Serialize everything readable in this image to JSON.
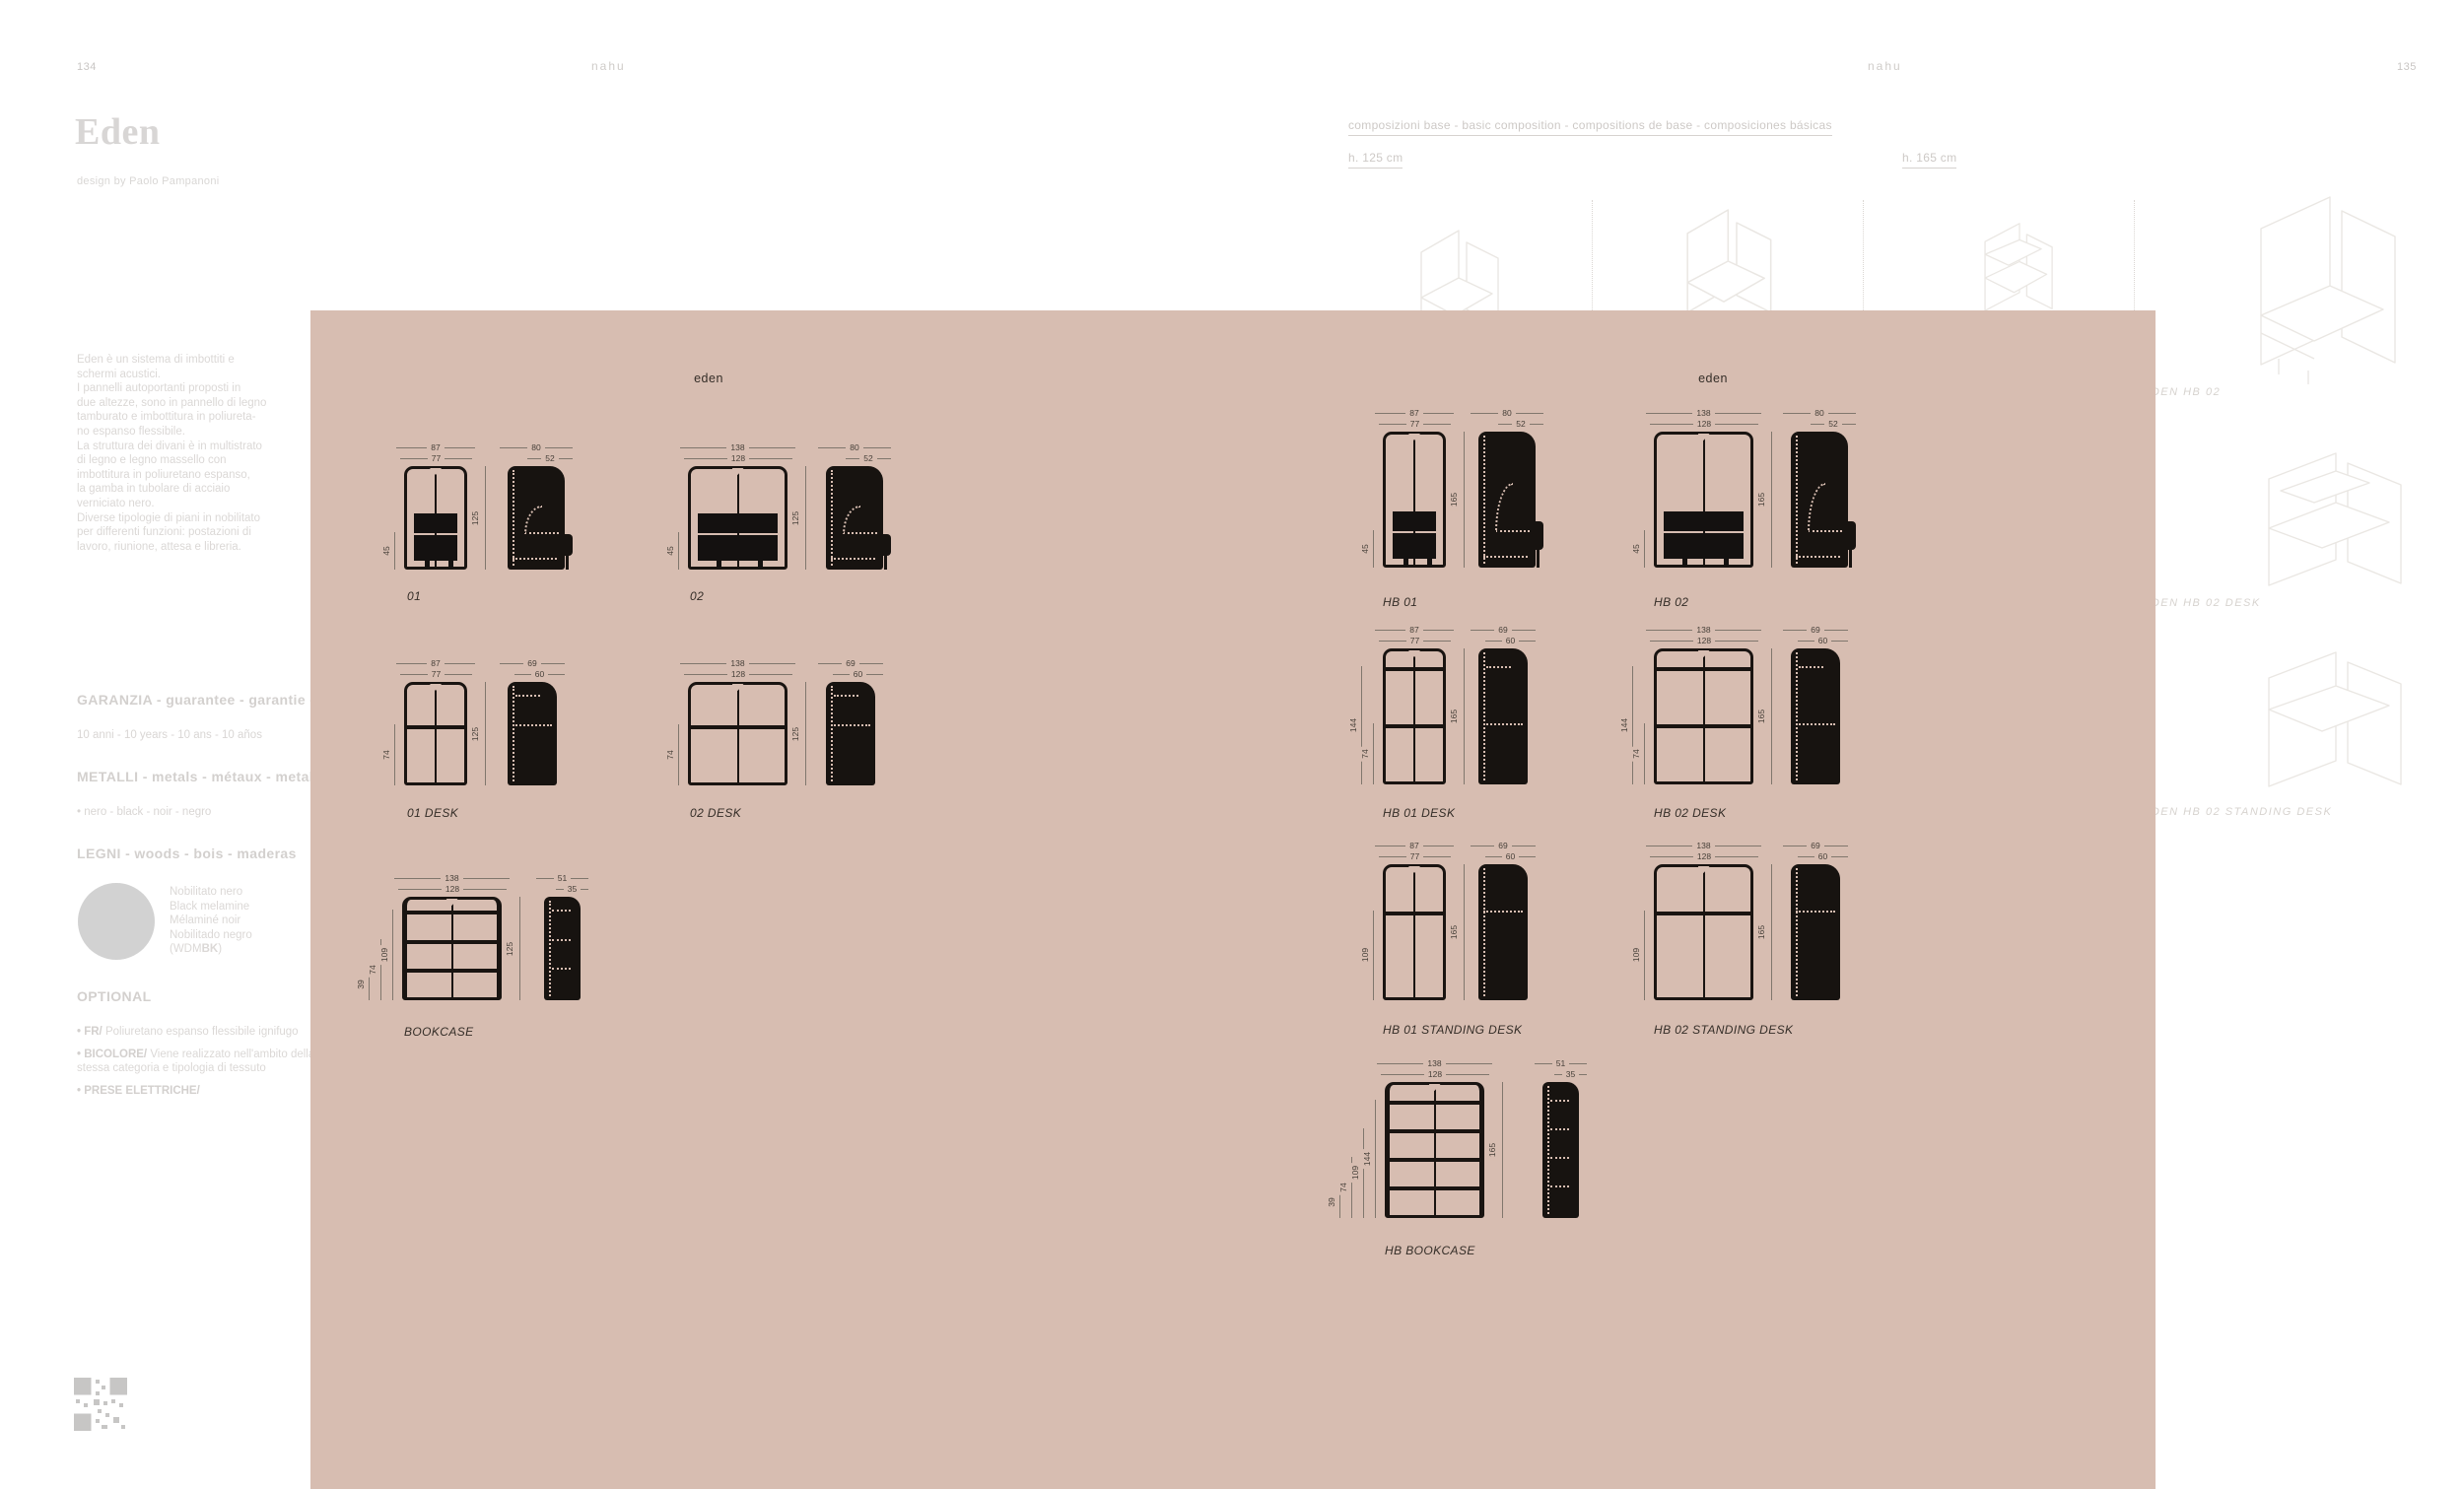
{
  "page": {
    "left_number": "134",
    "right_number": "135",
    "brand_left": "nahu",
    "brand_right": "nahu",
    "title": "Eden",
    "designer": "design by Paolo Pampanoni",
    "description_lines": [
      "Eden è un sistema di imbottiti e",
      "schermi acustici.",
      "I pannelli  autoportanti proposti in",
      "due altezze, sono in pannello di legno",
      "tamburato e imbottitura in poliureta-",
      "no espanso flessibile.",
      "La struttura dei divani è in multistrato",
      "di legno e legno massello con",
      "imbottitura in poliuretano espanso,",
      "la gamba  in tubolare di acciaio",
      "verniciato nero.",
      "Diverse tipologie di piani in nobilitato",
      "per differenti funzioni: postazioni di",
      "lavoro, riunione, attesa e libreria."
    ],
    "sections": {
      "garanzia": {
        "heading": "GARANZIA - guarantee - garantie - garantía",
        "text": "10 anni - 10 years - 10 ans - 10 años"
      },
      "metalli": {
        "heading": "METALLI - metals - métaux - metales",
        "text": "• nero - black - noir - negro"
      },
      "legni": {
        "heading": "LEGNI - woods - bois - maderas",
        "swatch_lines": [
          "Nobilitato nero",
          "Black melamine",
          "Mélaminé noir",
          "Nobilitado negro"
        ],
        "code_prefix": "(WDM",
        "code_bold": "BK",
        "code_suffix": ")"
      },
      "optional": {
        "heading": "OPTIONAL",
        "items": [
          {
            "bold": "• FR/",
            "text": " Poliuretano espanso flessibile ignifugo"
          },
          {
            "bold": "• BICOLORE/",
            "text": " Viene realizzato nell'ambito della stessa categoria e tipologia di tessuto"
          },
          {
            "bold": "• PRESE ELETTRICHE/",
            "text": ""
          }
        ]
      }
    },
    "header": {
      "compositions": "composizioni base - basic composition - compositions de base - composiciones básicas",
      "h125": "h. 125 cm",
      "h165": "h. 165 cm"
    },
    "side_labels": [
      "EDEN HB 02",
      "EDEN HB 02 DESK",
      "EDEN HB 02 STANDING DESK"
    ]
  },
  "panel": {
    "bg": "#d7bdb1",
    "groups": [
      {
        "heading": "eden",
        "diagrams": [
          {
            "label": "01",
            "type": "sofa",
            "height_cm": 125,
            "front_cm": [
              87,
              77
            ],
            "left_cm": [
              45
            ],
            "side_cm": [
              80,
              52
            ],
            "side_marks": []
          },
          {
            "label": "02",
            "type": "sofa",
            "height_cm": 125,
            "front_cm": [
              138,
              128
            ],
            "left_cm": [
              45
            ],
            "side_cm": [
              80,
              52
            ],
            "side_marks": []
          },
          {
            "label": "01 DESK",
            "type": "desk",
            "height_cm": 125,
            "front_cm": [
              87,
              77
            ],
            "left_cm": [
              74
            ],
            "side_cm": [
              69,
              60
            ],
            "side_marks": [
              {
                "cm": 109,
                "full": false
              },
              {
                "cm": 74,
                "full": true
              }
            ]
          },
          {
            "label": "02 DESK",
            "type": "desk",
            "height_cm": 125,
            "front_cm": [
              138,
              128
            ],
            "left_cm": [
              74
            ],
            "side_cm": [
              69,
              60
            ],
            "side_marks": [
              {
                "cm": 109,
                "full": false
              },
              {
                "cm": 74,
                "full": true
              }
            ]
          },
          {
            "label": "BOOKCASE",
            "type": "bookcase",
            "height_cm": 125,
            "front_cm": [
              138,
              128
            ],
            "left_cm": [
              39,
              74,
              109
            ],
            "side_cm": [
              51,
              35
            ],
            "side_marks": [
              {
                "cm": 109,
                "full": false
              },
              {
                "cm": 74,
                "full": false
              },
              {
                "cm": 39,
                "full": false
              }
            ]
          }
        ]
      },
      {
        "heading": "eden",
        "diagrams": [
          {
            "label": "HB 01",
            "type": "sofa",
            "height_cm": 165,
            "front_cm": [
              87,
              77
            ],
            "left_cm": [
              45
            ],
            "side_cm": [
              80,
              52
            ],
            "side_marks": []
          },
          {
            "label": "HB 02",
            "type": "sofa",
            "height_cm": 165,
            "front_cm": [
              138,
              128
            ],
            "left_cm": [
              45
            ],
            "side_cm": [
              80,
              52
            ],
            "side_marks": []
          },
          {
            "label": "HB 01 DESK",
            "type": "desk",
            "height_cm": 165,
            "front_cm": [
              87,
              77
            ],
            "left_cm": [
              144,
              74
            ],
            "side_cm": [
              69,
              60
            ],
            "side_marks": [
              {
                "cm": 144,
                "full": false
              },
              {
                "cm": 74,
                "full": true
              }
            ]
          },
          {
            "label": "HB 02 DESK",
            "type": "desk",
            "height_cm": 165,
            "front_cm": [
              138,
              128
            ],
            "left_cm": [
              144,
              74
            ],
            "side_cm": [
              69,
              60
            ],
            "side_marks": [
              {
                "cm": 144,
                "full": false
              },
              {
                "cm": 74,
                "full": true
              }
            ]
          },
          {
            "label": "HB 01 STANDING DESK",
            "type": "desk",
            "height_cm": 165,
            "front_cm": [
              87,
              77
            ],
            "left_cm": [
              109
            ],
            "side_cm": [
              69,
              60
            ],
            "side_marks": [
              {
                "cm": 109,
                "full": true
              }
            ]
          },
          {
            "label": "HB 02 STANDING DESK",
            "type": "desk",
            "height_cm": 165,
            "front_cm": [
              138,
              128
            ],
            "left_cm": [
              109
            ],
            "side_cm": [
              69,
              60
            ],
            "side_marks": [
              {
                "cm": 109,
                "full": true
              }
            ]
          },
          {
            "label": "HB BOOKCASE",
            "type": "bookcase",
            "height_cm": 165,
            "front_cm": [
              138,
              128
            ],
            "left_cm": [
              39,
              74,
              109,
              144
            ],
            "side_cm": [
              51,
              35
            ],
            "side_marks": [
              {
                "cm": 144,
                "full": false
              },
              {
                "cm": 109,
                "full": false
              },
              {
                "cm": 74,
                "full": false
              },
              {
                "cm": 39,
                "full": false
              }
            ]
          }
        ]
      }
    ]
  }
}
